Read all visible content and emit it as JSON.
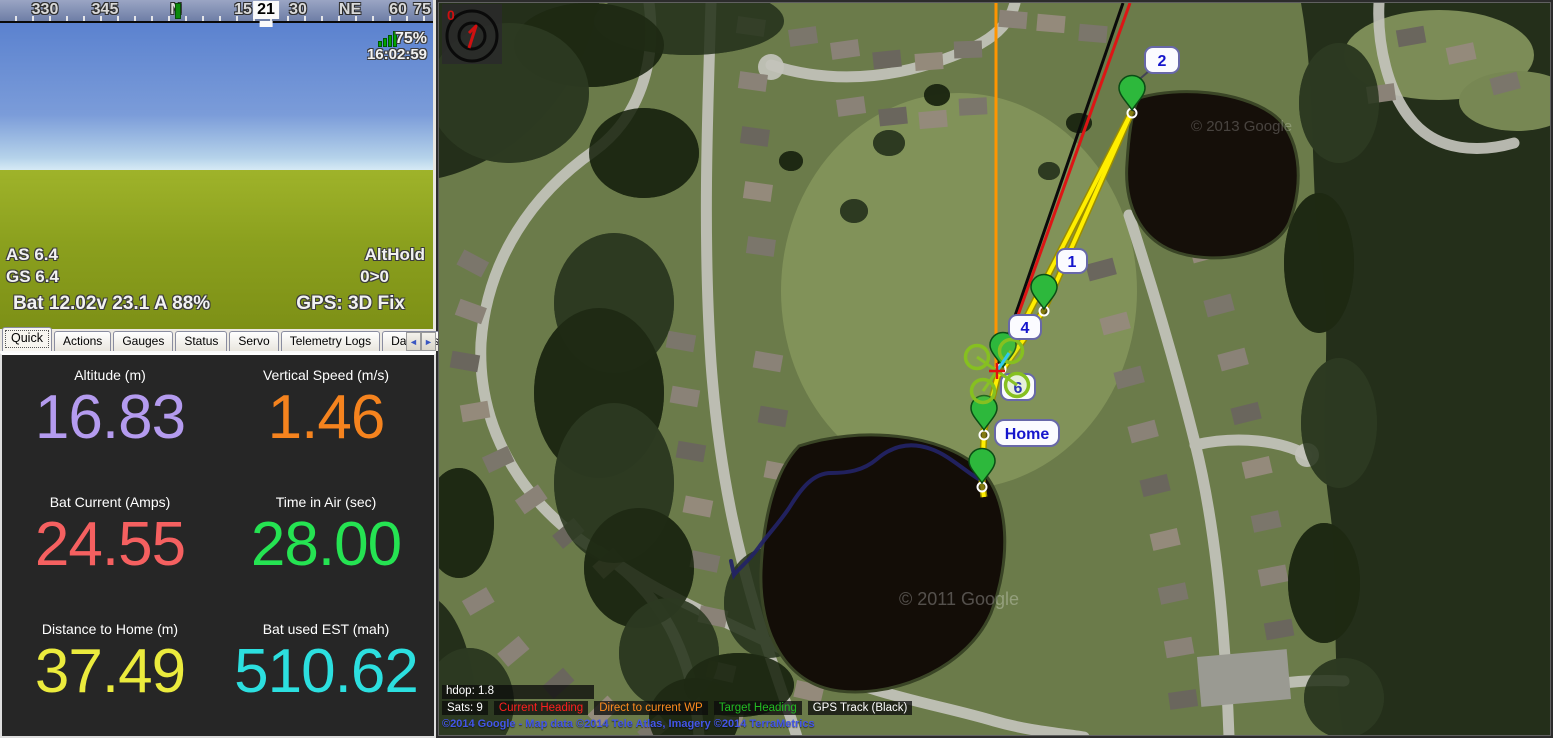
{
  "hud": {
    "compass_labels": [
      "330",
      "345",
      "N",
      "15",
      "21",
      "30",
      "NE",
      "60",
      "75"
    ],
    "current_heading": "21",
    "roll_labels": [
      "60",
      "45",
      "30",
      "20",
      "10",
      "0",
      "10",
      "20",
      "30",
      "45",
      "60"
    ],
    "pitch_labels": [
      "20",
      "10",
      "0",
      "-10",
      "-20"
    ],
    "airspeed_tape": {
      "labels": [
        "15",
        "10",
        "0",
        "-5"
      ],
      "current": "6"
    },
    "altitude_tape": {
      "labels": [
        "30",
        "25",
        "15",
        "10"
      ],
      "current": "21"
    },
    "link_quality": "75%",
    "time": "16:02:59",
    "airspeed_text": "AS 6.4",
    "groundspeed_text": "GS 6.4",
    "flight_mode": "AltHold",
    "waypoint_status": "0>0",
    "battery_text": "Bat 12.02v 23.1 A 88%",
    "gps_text": "GPS: 3D Fix"
  },
  "tabs": {
    "labels": [
      "Quick",
      "Actions",
      "Gauges",
      "Status",
      "Servo",
      "Telemetry Logs",
      "DataFlash Logs"
    ],
    "active": "Quick",
    "scroll_left": "◄",
    "scroll_right": "►"
  },
  "quick_panel": {
    "cells": [
      {
        "label": "Altitude (m)",
        "value": "16.83",
        "color": "#b49bef"
      },
      {
        "label": "Vertical Speed (m/s)",
        "value": "1.46",
        "color": "#f5831e"
      },
      {
        "label": "Bat Current (Amps)",
        "value": "24.55",
        "color": "#f56060"
      },
      {
        "label": "Time in Air (sec)",
        "value": "28.00",
        "color": "#25e352"
      },
      {
        "label": "Distance to Home (m)",
        "value": "37.49",
        "color": "#ebeb3d"
      },
      {
        "label": "Bat used EST (mah)",
        "value": "510.62",
        "color": "#2cdfdf"
      }
    ]
  },
  "map": {
    "gimbal_heading": "0",
    "waypoint_labels": [
      "2",
      "1",
      "4",
      "6",
      "Home"
    ],
    "hdop_text": "hdop: 1.8",
    "legend": [
      {
        "label": "Sats: 9",
        "color": "#ffffff"
      },
      {
        "label": "Current Heading",
        "color": "#ff1f1f"
      },
      {
        "label": "Direct to current WP",
        "color": "#ff8c1e"
      },
      {
        "label": "Target Heading",
        "color": "#22bb22"
      },
      {
        "label": "GPS Track (Black)",
        "color": "#ffffff"
      }
    ],
    "copyright": "©2014 Google - Map data ©2014 Tele Atlas, Imagery ©2014 TerraMetrics",
    "watermark_center": "© 2011 Google",
    "watermark_upper": "© 2013 Google",
    "colors": {
      "mission_line": "#ffee00",
      "current_heading_line": "#dd1515",
      "gps_track_line": "#0a0a0a",
      "direct_to_wp_line": "#ff9500",
      "flown_track": "#232366"
    }
  }
}
